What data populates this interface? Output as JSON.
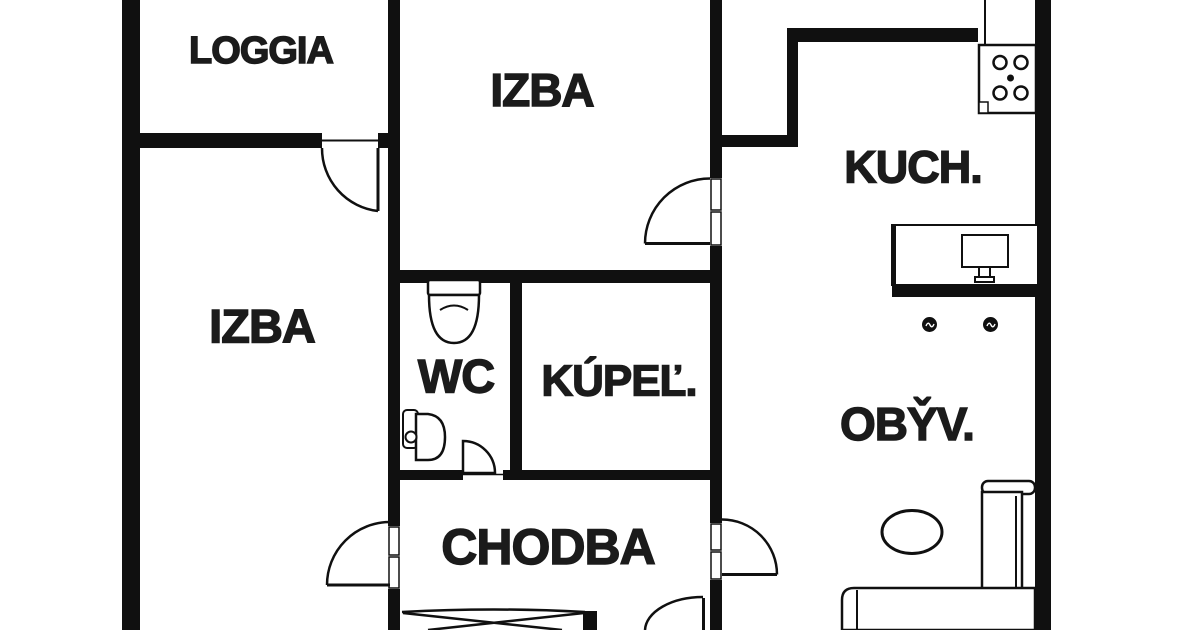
{
  "colors": {
    "background": "#ffffff",
    "wall": "#101010",
    "label": "#1b1b1b"
  },
  "rooms": [
    {
      "id": "loggia",
      "label": "LOGGIA"
    },
    {
      "id": "izba_top",
      "label": "IZBA"
    },
    {
      "id": "izba_left",
      "label": "IZBA"
    },
    {
      "id": "kuch",
      "label": "KUCH."
    },
    {
      "id": "wc",
      "label": "WC"
    },
    {
      "id": "kupel",
      "label": "KÚPEĽ."
    },
    {
      "id": "obyv",
      "label": "OBY̌V."
    },
    {
      "id": "chodba",
      "label": "CHODBA"
    }
  ],
  "icons": [
    "stove-icon",
    "toilet-icon",
    "sink-icon",
    "desk-monitor-icon",
    "ceiling-light-icon",
    "coffee-table-icon",
    "sofa-icon",
    "bed-icon",
    "door-swing-icon"
  ]
}
